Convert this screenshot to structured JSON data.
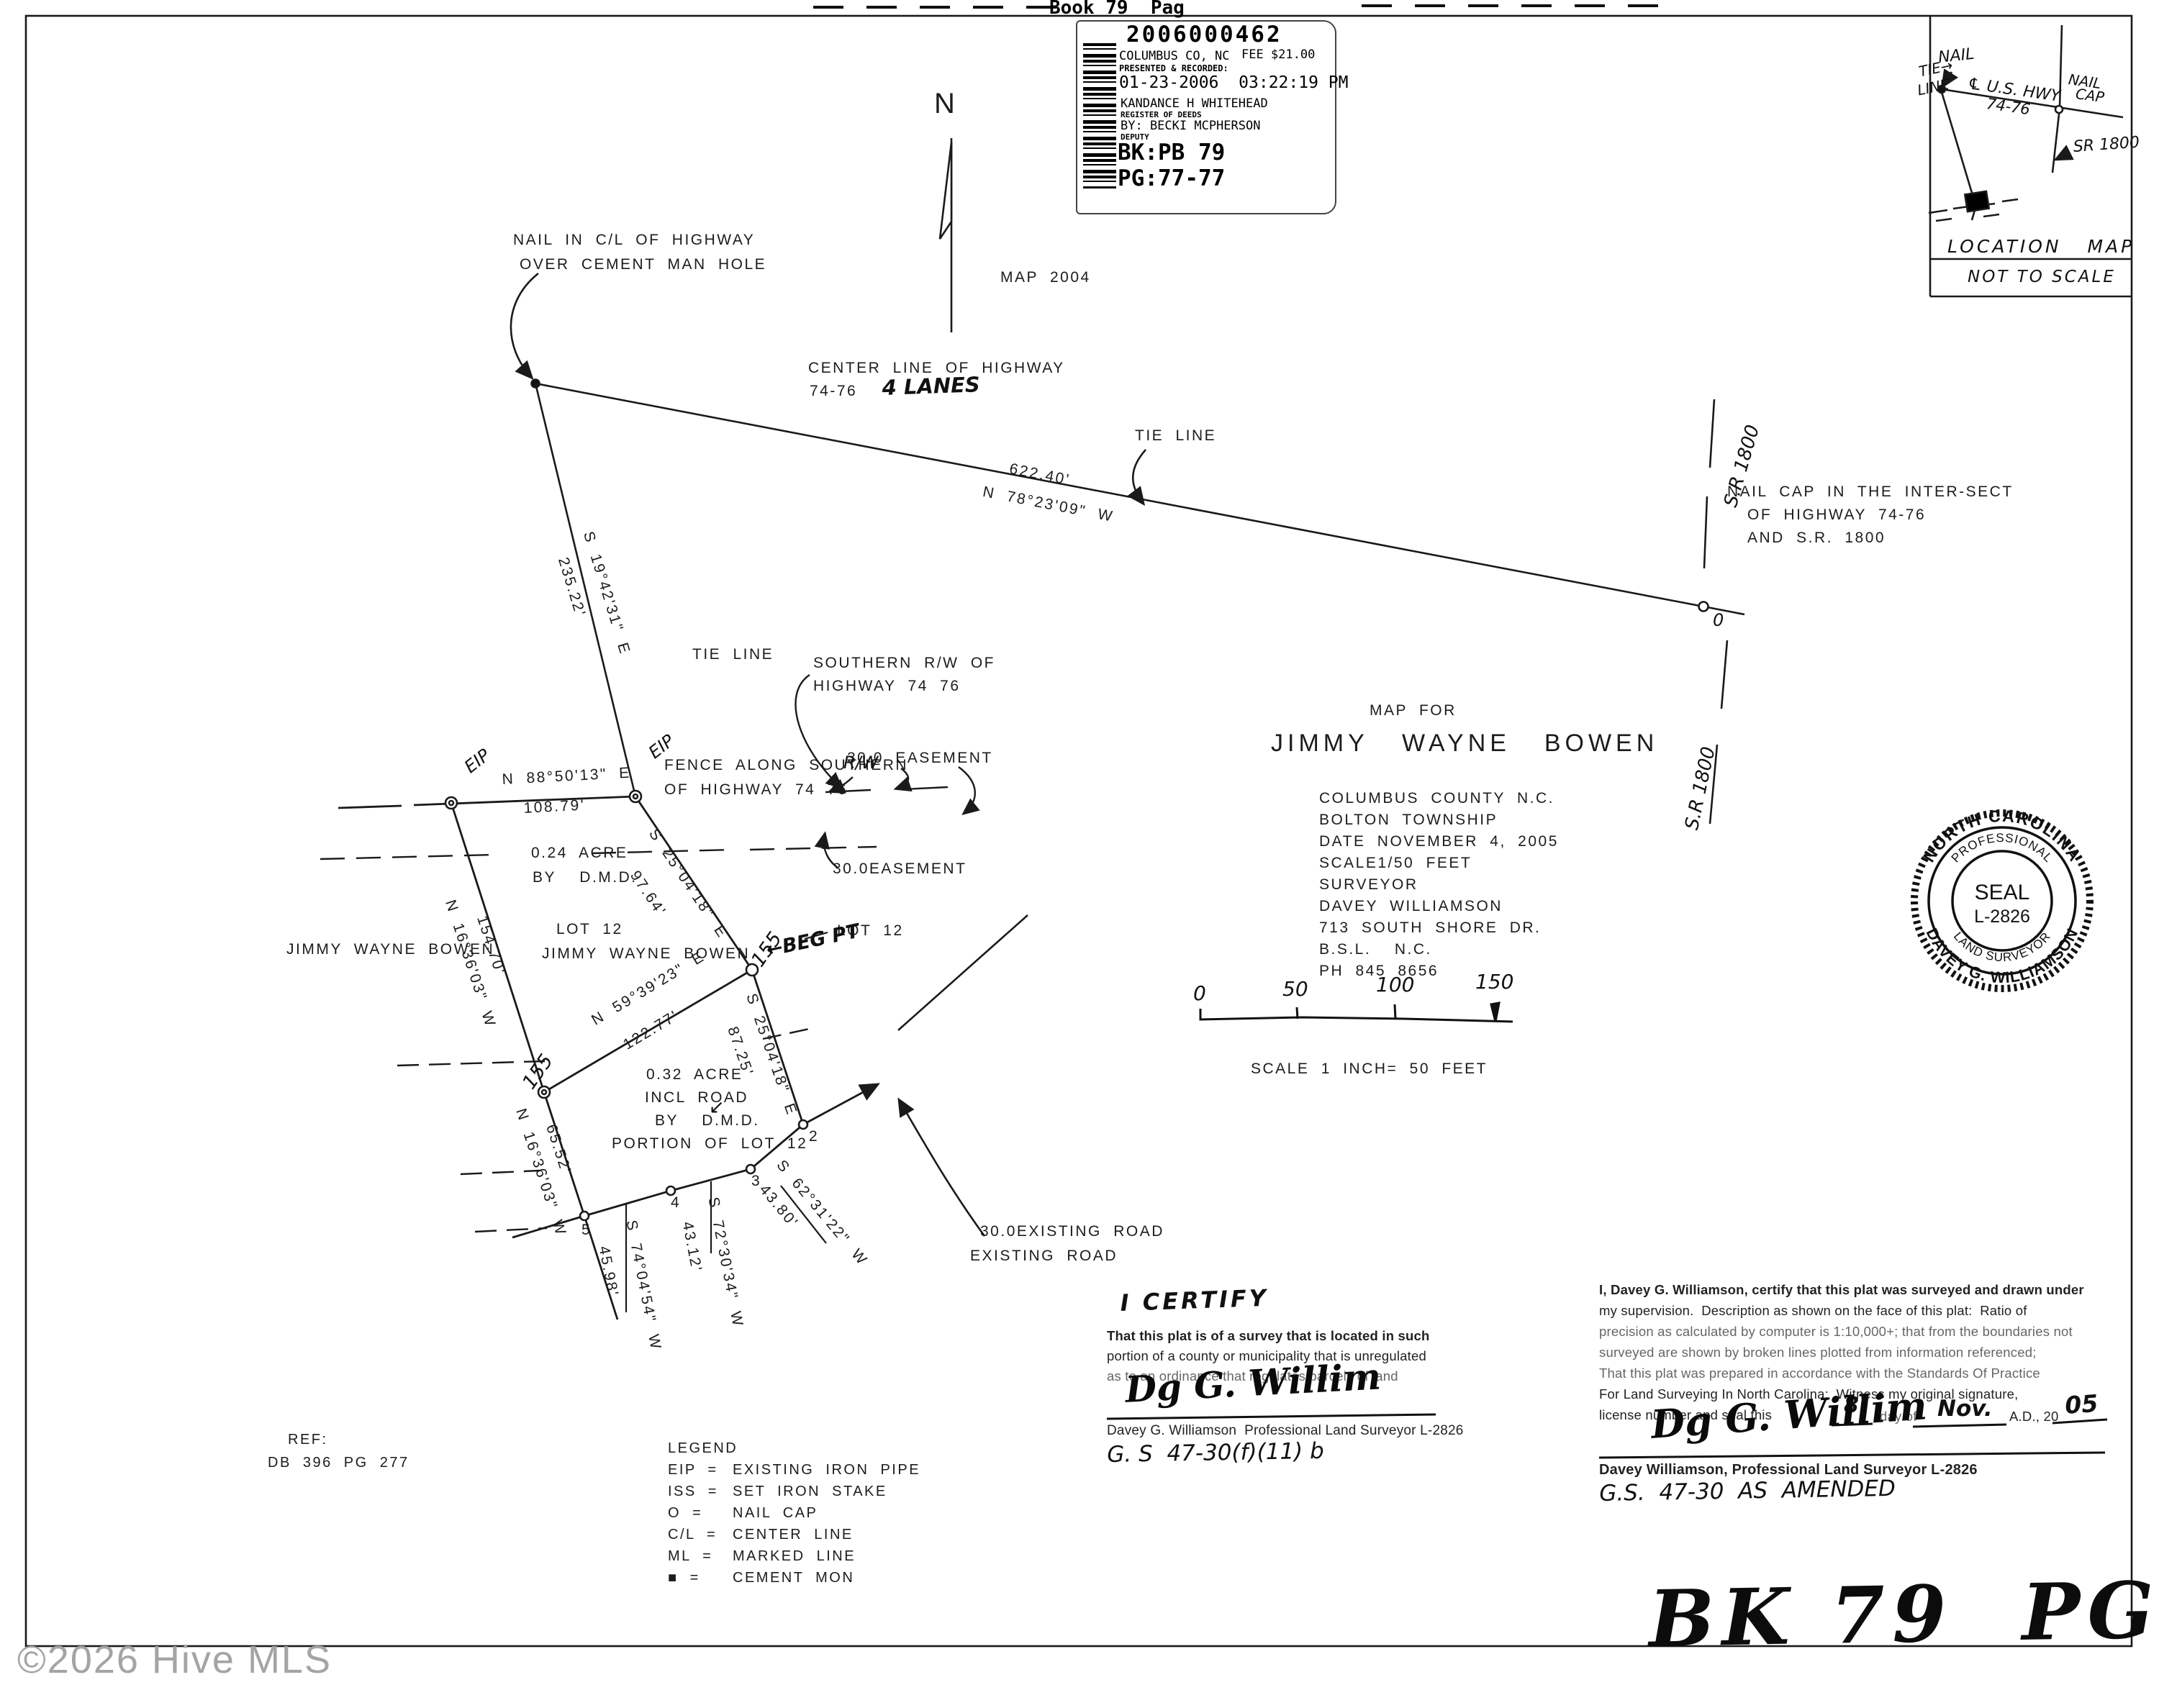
{
  "page": {
    "header_partial": "Book 79  Pag",
    "watermark": "©2026 Hive MLS",
    "handwritten_book_page": "BK 79  PG 77",
    "north_label": "N",
    "map_note": "MAP 2004"
  },
  "stamp": {
    "doc_number": "2006000462",
    "county": "COLUMBUS CO, NC",
    "fee": "FEE $21.00",
    "presented": "PRESENTED & RECORDED:",
    "datetime": "01-23-2006  03:22:19 PM",
    "register": "KANDANCE H WHITEHEAD",
    "register_title": "REGISTER OF DEEDS",
    "deputy_by": "BY: BECKI MCPHERSON",
    "deputy_title": "DEPUTY",
    "bk": "BK:PB 79",
    "pg": "PG:77-77"
  },
  "location_map": {
    "nail": "NAIL",
    "tie1": "TIE→",
    "tie2": "LINE",
    "hwy1": "℄ U.S. HWY",
    "hwy2": "74-76",
    "nailcap1": "NAIL",
    "nailcap2": "CAP",
    "sr": "SR 1800",
    "title": "LOCATION   MAP",
    "scale": "NOT TO SCALE"
  },
  "nail_note": {
    "l1": "NAIL IN C/L OF HIGHWAY",
    "l2": "OVER CEMENT MAN HOLE"
  },
  "highway": {
    "l1": "CENTER LINE OF HIGHWAY",
    "l2": "74-76",
    "lanes": "4 LANES",
    "dist": "622.40'",
    "bearing": "N 78°23'09\" W",
    "tie": "TIE LINE"
  },
  "nailcap_note": {
    "l1": "NAIL CAP IN THE INTER-SECT",
    "l2": "OF HIGHWAY 74-76",
    "l3": "AND S.R. 1800"
  },
  "sr1800_upper": "S.R 1800",
  "sr1800_lower": "S.R 1800",
  "zero_mark": "0",
  "tie": {
    "bearing": "S 19°42'31\" E",
    "dist": "235.22'",
    "label": "TIE LINE"
  },
  "rw": {
    "southern1": "SOUTHERN R/W OF",
    "southern2": "HIGHWAY 74 76",
    "fence1": "FENCE ALONG SOUTHERN",
    "fence_rw": "R/W",
    "fence2": "OF HIGHWAY 74 76",
    "easement": "30.0 EASEMENT",
    "easement2": "30.0EASEMENT"
  },
  "parcel1": {
    "eip_left": "EIP",
    "eip_right": "EIP",
    "top_b": "N 88°50'13\" E",
    "top_d": "108.79'",
    "right_b": "S 25°04'18\" E",
    "right_d": "97.64'",
    "left_b": "N 16°36'03\" W",
    "left_d": "154.70'",
    "acre1": "0.24 ACRE",
    "acre2": "BY  D.M.D.",
    "lot": "LOT 12",
    "owner": "JIMMY WAYNE BOWEN"
  },
  "parcel2": {
    "mid_b": "N 59°39'23\" E",
    "mid_d": "122.77'",
    "right_b": "S 25°04'18\" E",
    "right_d": "87.25'",
    "left_b": "N 16°36'03\" W",
    "left_d": "65.52'",
    "s23_b": "S 62°31'22\" W",
    "s23_d": "43.80'",
    "s34_b": "S 72°30'34\" W",
    "s34_d": "43.12'",
    "s45_b": "S 74°04'54\" W",
    "s45_d": "45.98'",
    "acre1": "0.32 ACRE",
    "acre2": "INCL ROAD",
    "acre3": "BY  D.M.D.",
    "acre4": "PORTION OF LOT 12",
    "arrow_mark": "↙"
  },
  "points": {
    "p155a": "155",
    "p155b": "155",
    "begpt": "←BEG PT",
    "p2": "2",
    "p3": "3",
    "p4": "4",
    "p5": "5",
    "lot12_right": "LOT 12"
  },
  "owner_left": "JIMMY WAYNE BOWEN",
  "road": {
    "l1": "30.0EXISTING ROAD",
    "l2": "EXISTING ROAD"
  },
  "title_block": {
    "map_for": "MAP FOR",
    "name": "JIMMY  WAYNE  BOWEN",
    "lines": [
      "COLUMBUS COUNTY N.C.",
      "BOLTON TOWNSHIP",
      "DATE NOVEMBER 4, 2005",
      "SCALE1/50 FEET",
      "SURVEYOR",
      "DAVEY WILLIAMSON",
      "713 SOUTH SHORE DR.",
      "B.S.L.  N.C.",
      "PH 845 8656"
    ]
  },
  "scalebar": {
    "t0": "0",
    "t50": "50",
    "t100": "100",
    "t150": "150",
    "caption": "SCALE 1 INCH= 50 FEET"
  },
  "seal": {
    "arc_top": "NORTH CAROLINA",
    "arc_bottom": "DAVEY G. WILLIAMSON",
    "inner_top": "PROFESSIONAL",
    "inner_bottom": "LAND SURVEYOR",
    "center1": "SEAL",
    "center2": "L-2826"
  },
  "ref": {
    "l1": "REF:",
    "l2": "DB 396 PG 277"
  },
  "legend": {
    "title": "LEGEND",
    "items": [
      {
        "k": "EIP =",
        "v": "EXISTING IRON PIPE"
      },
      {
        "k": "ISS =",
        "v": "SET IRON STAKE"
      },
      {
        "k": "O =",
        "v": "NAIL CAP"
      },
      {
        "k": "C/L =",
        "v": "CENTER LINE"
      },
      {
        "k": "ML =",
        "v": "MARKED LINE"
      },
      {
        "k": "■ =",
        "v": "CEMENT MON"
      }
    ]
  },
  "cert_left": {
    "title": "I CERTIFY",
    "lines": [
      "That this plat is of a survey that is located in such",
      "portion of a county or municipality that is unregulated",
      "as to an ordinance that regulates parcels of land"
    ],
    "sig": "Dg G. Willim",
    "name": "Davey G. Williamson  Professional Land Surveyor L-2826",
    "gs": "G. S  47-30(f)(11) b"
  },
  "cert_right": {
    "lines": [
      "I, Davey G. Williamson, certify that this plat was surveyed and drawn under",
      "my supervision.  Description as shown on the face of this plat:  Ratio of",
      "precision as calculated by computer is 1:10,000+; that from the boundaries not",
      "surveyed are shown by broken lines plotted from information referenced;",
      "That this plat was prepared in accordance with the Standards Of Practice",
      "For Land Surveying In North Carolina;  Witness my original signature,",
      "license number and seal this"
    ],
    "day": "8",
    "day_of": "day of",
    "month": "Nov.",
    "ad": "A.D., 20",
    "year": "05",
    "sig": "Dg G. Willim",
    "name": "Davey Williamson, Professional Land Surveyor L-2826",
    "gs": "G.S.  47-30  AS  AMENDED"
  }
}
